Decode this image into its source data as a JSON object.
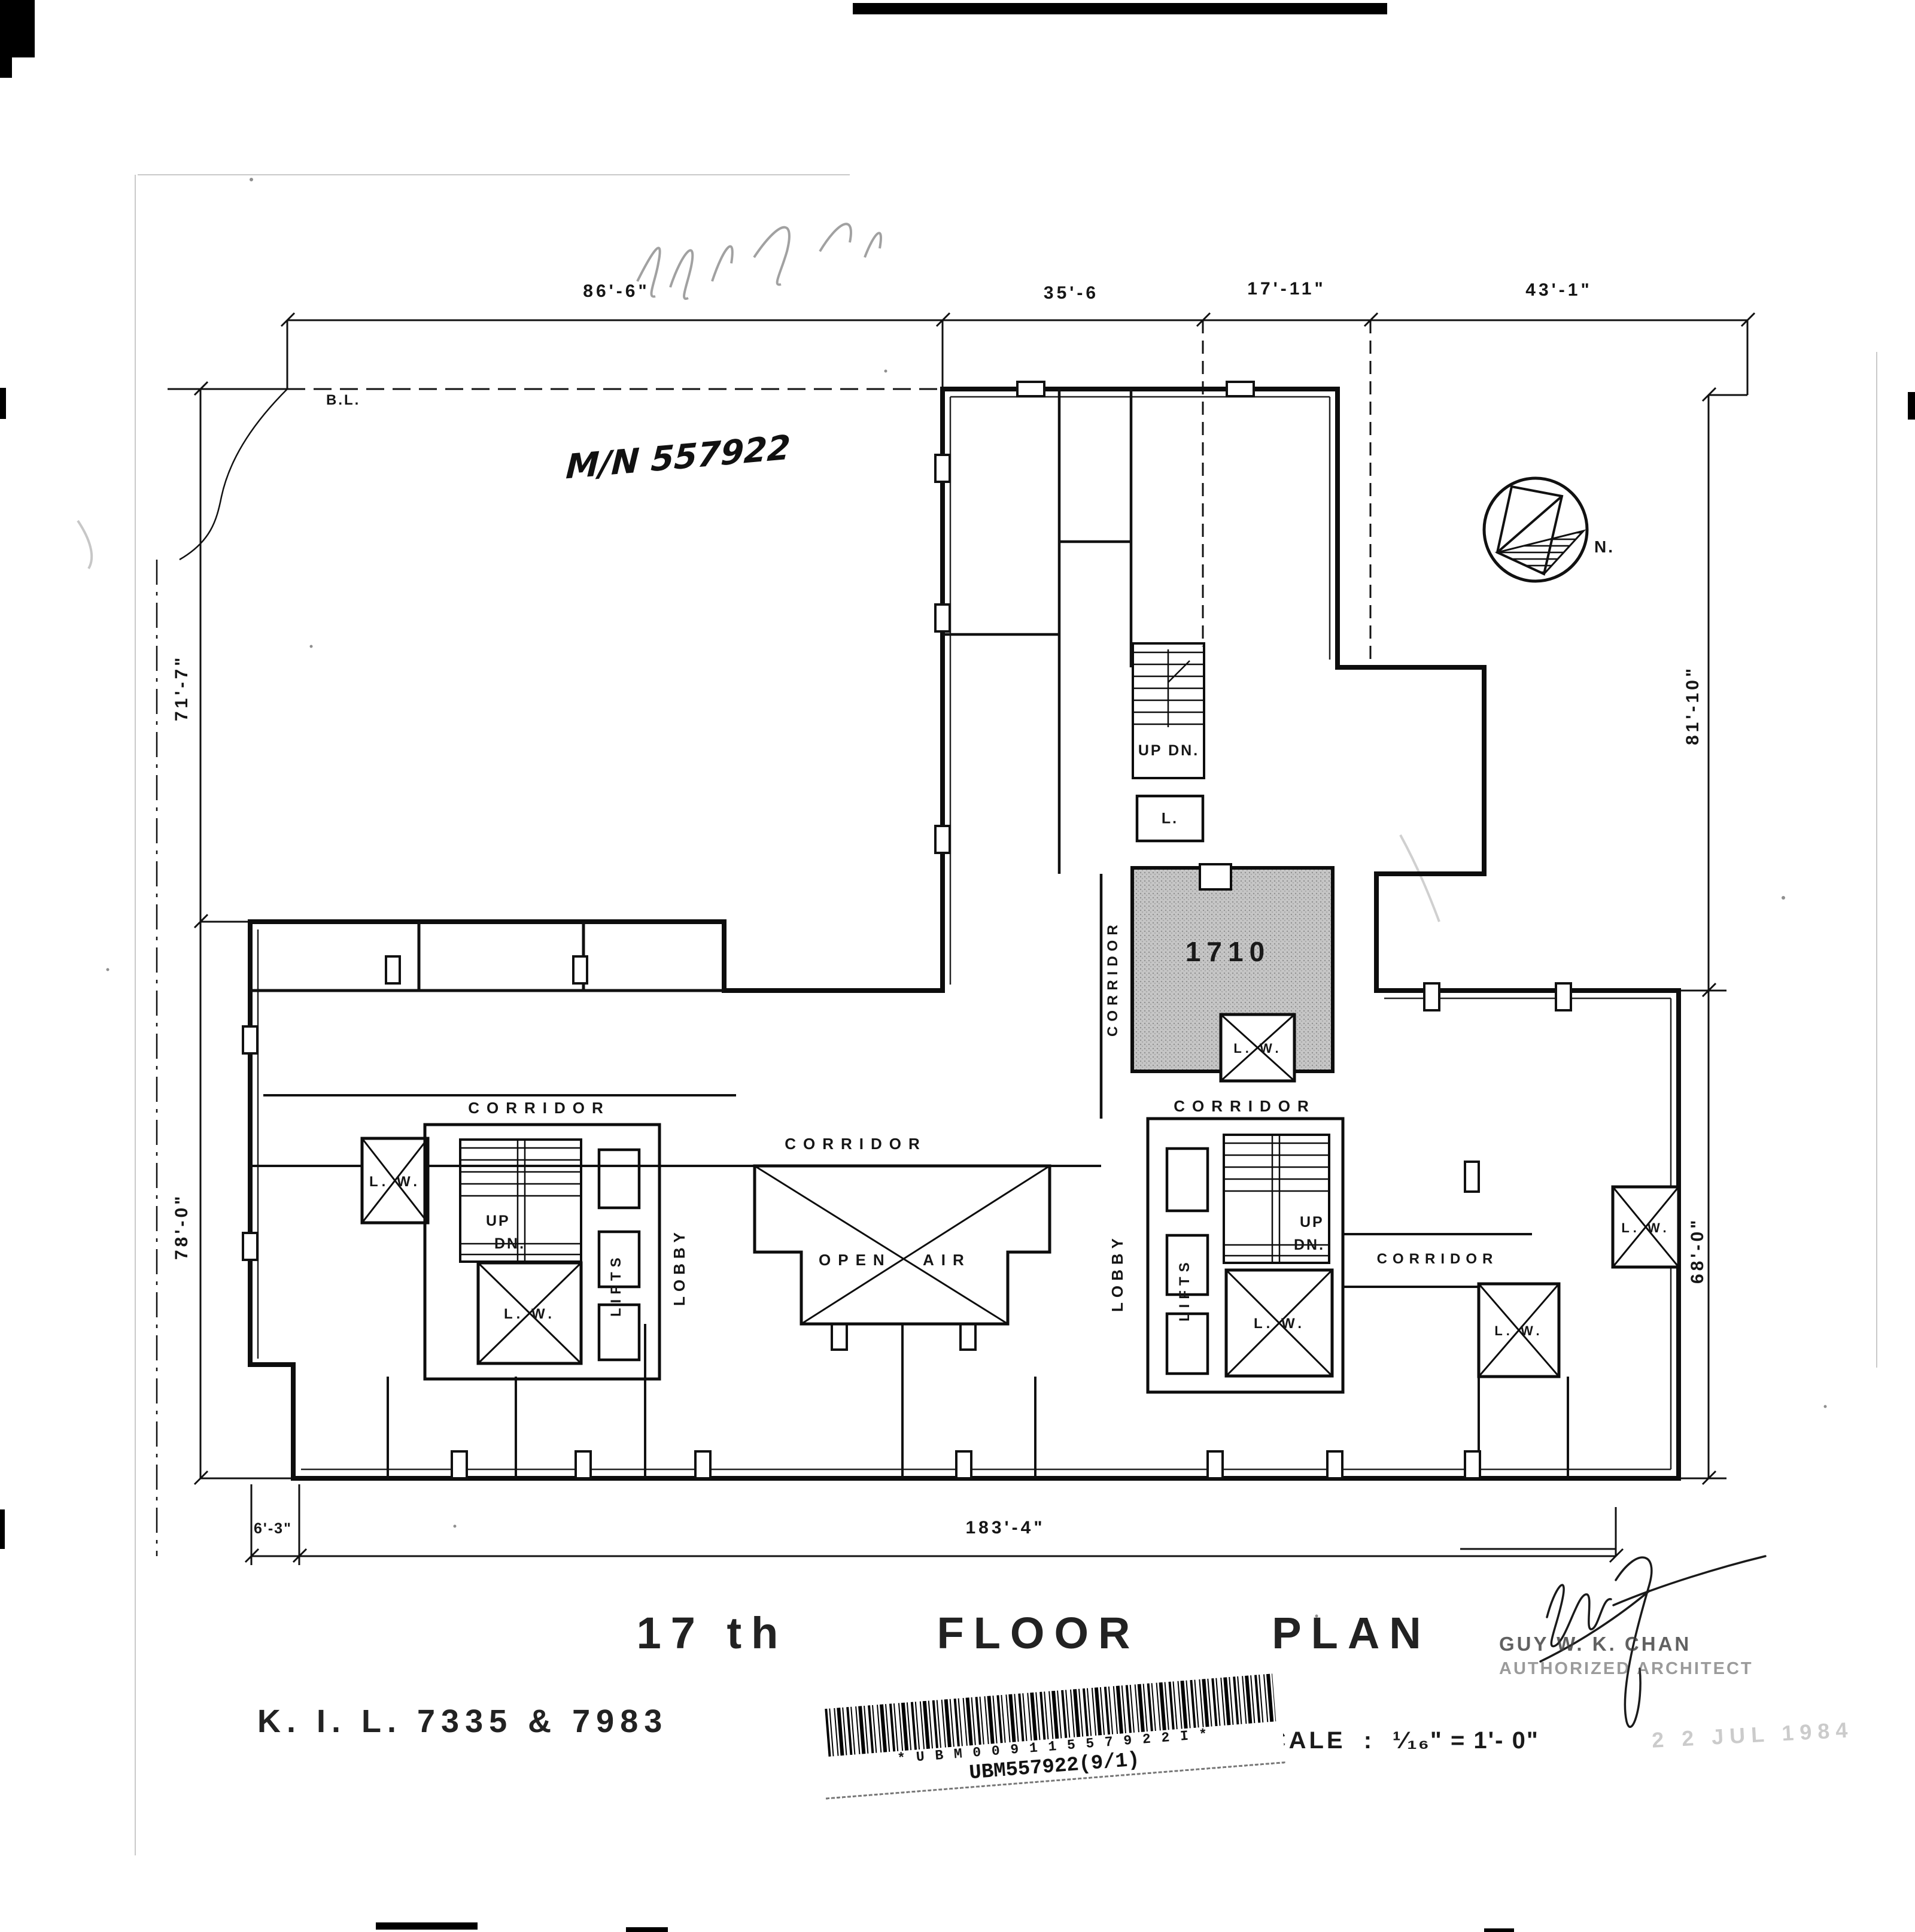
{
  "annotations": {
    "pencil_note": "M/N 557922",
    "boundary_label": "B.L.",
    "north_label": "N."
  },
  "dimensions": {
    "top": [
      "86'-6\"",
      "35'-6",
      "17'-11\"",
      "43'-1\""
    ],
    "left": [
      "71'-7\"",
      "78'-0\""
    ],
    "right": [
      "81'-10\"",
      "68'-0\""
    ],
    "bottom": [
      "6'-3\"",
      "183'-4\""
    ]
  },
  "rooms": {
    "unit_number": "1710",
    "corridor": "CORRIDOR",
    "lobby": "LOBBY",
    "lifts": "LIFTS",
    "open_air_1": "OPEN",
    "open_air_2": "AIR",
    "lightwell": "L. W.",
    "lavatory": "L.",
    "stair_up_down": "UP DN.",
    "up": "UP",
    "down": "DN."
  },
  "title_block": {
    "floor": "17 th",
    "floor_word": "FLOOR",
    "plan_word": "PLAN",
    "lot": "K. I. L.  7335  &  7983",
    "scale_label": "SCALE",
    "scale_separator": ":",
    "scale_value": "¹⁄₁₆\" = 1'- 0\"",
    "date_stamp": "2 2 JUL 1984"
  },
  "architect": {
    "name": "GUY  W. K.  CHAN",
    "role": "AUTHORIZED ARCHITECT"
  },
  "barcode": {
    "chars": "* U B M 0 0 9 1 1 5 5 7 9 2 2 I *",
    "label": "UBM557922(9/1)"
  }
}
